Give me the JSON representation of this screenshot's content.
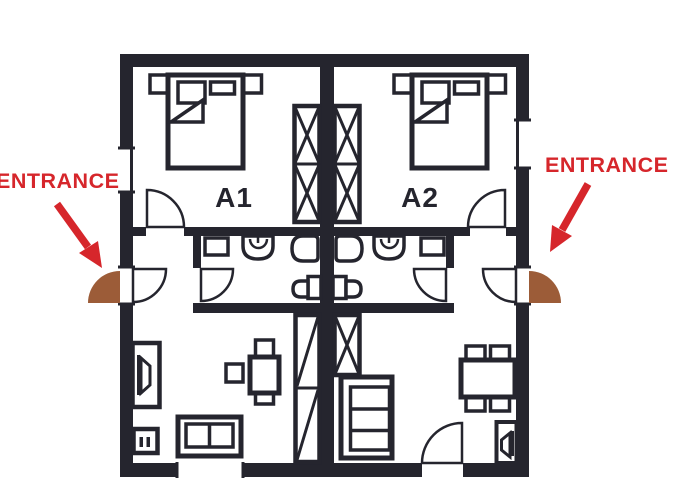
{
  "colors": {
    "ink": "#25252e",
    "accent_red": "#d6262b",
    "door_brown": "#9c5c38",
    "background": "#ffffff"
  },
  "labels": {
    "unit_a1": "A1",
    "unit_a2": "A2",
    "entrance_left": "ENTRANCE",
    "entrance_right": "ENTRANCE"
  },
  "plan": {
    "type": "floor-plan",
    "units": [
      {
        "name": "A1",
        "entrance_side": "left",
        "rooms": [
          "bedroom",
          "bathroom",
          "hallway",
          "living-room"
        ],
        "bedroom_furniture": [
          "double-bed",
          "nightstand",
          "nightstand",
          "wardrobe"
        ],
        "bathroom_fixtures": [
          "cabinet",
          "sink",
          "toilet",
          "bidet"
        ],
        "living_furniture": [
          "tv-cabinet",
          "electrical-panel",
          "table",
          "chairs",
          "sofa"
        ],
        "openings": [
          "entrance-door-left-wall",
          "window-left-wall",
          "window-bottom-wall"
        ]
      },
      {
        "name": "A2",
        "entrance_side": "right",
        "rooms": [
          "bedroom",
          "bathroom",
          "hallway",
          "living-room"
        ],
        "bedroom_furniture": [
          "double-bed",
          "nightstand",
          "nightstand",
          "wardrobe"
        ],
        "bathroom_fixtures": [
          "cabinet",
          "sink",
          "toilet",
          "bidet"
        ],
        "living_furniture": [
          "bookshelf",
          "dining-table",
          "chairs",
          "tv-cabinet"
        ],
        "openings": [
          "entrance-door-right-wall",
          "window-right-wall",
          "terrace-door-bottom-wall"
        ]
      }
    ]
  }
}
